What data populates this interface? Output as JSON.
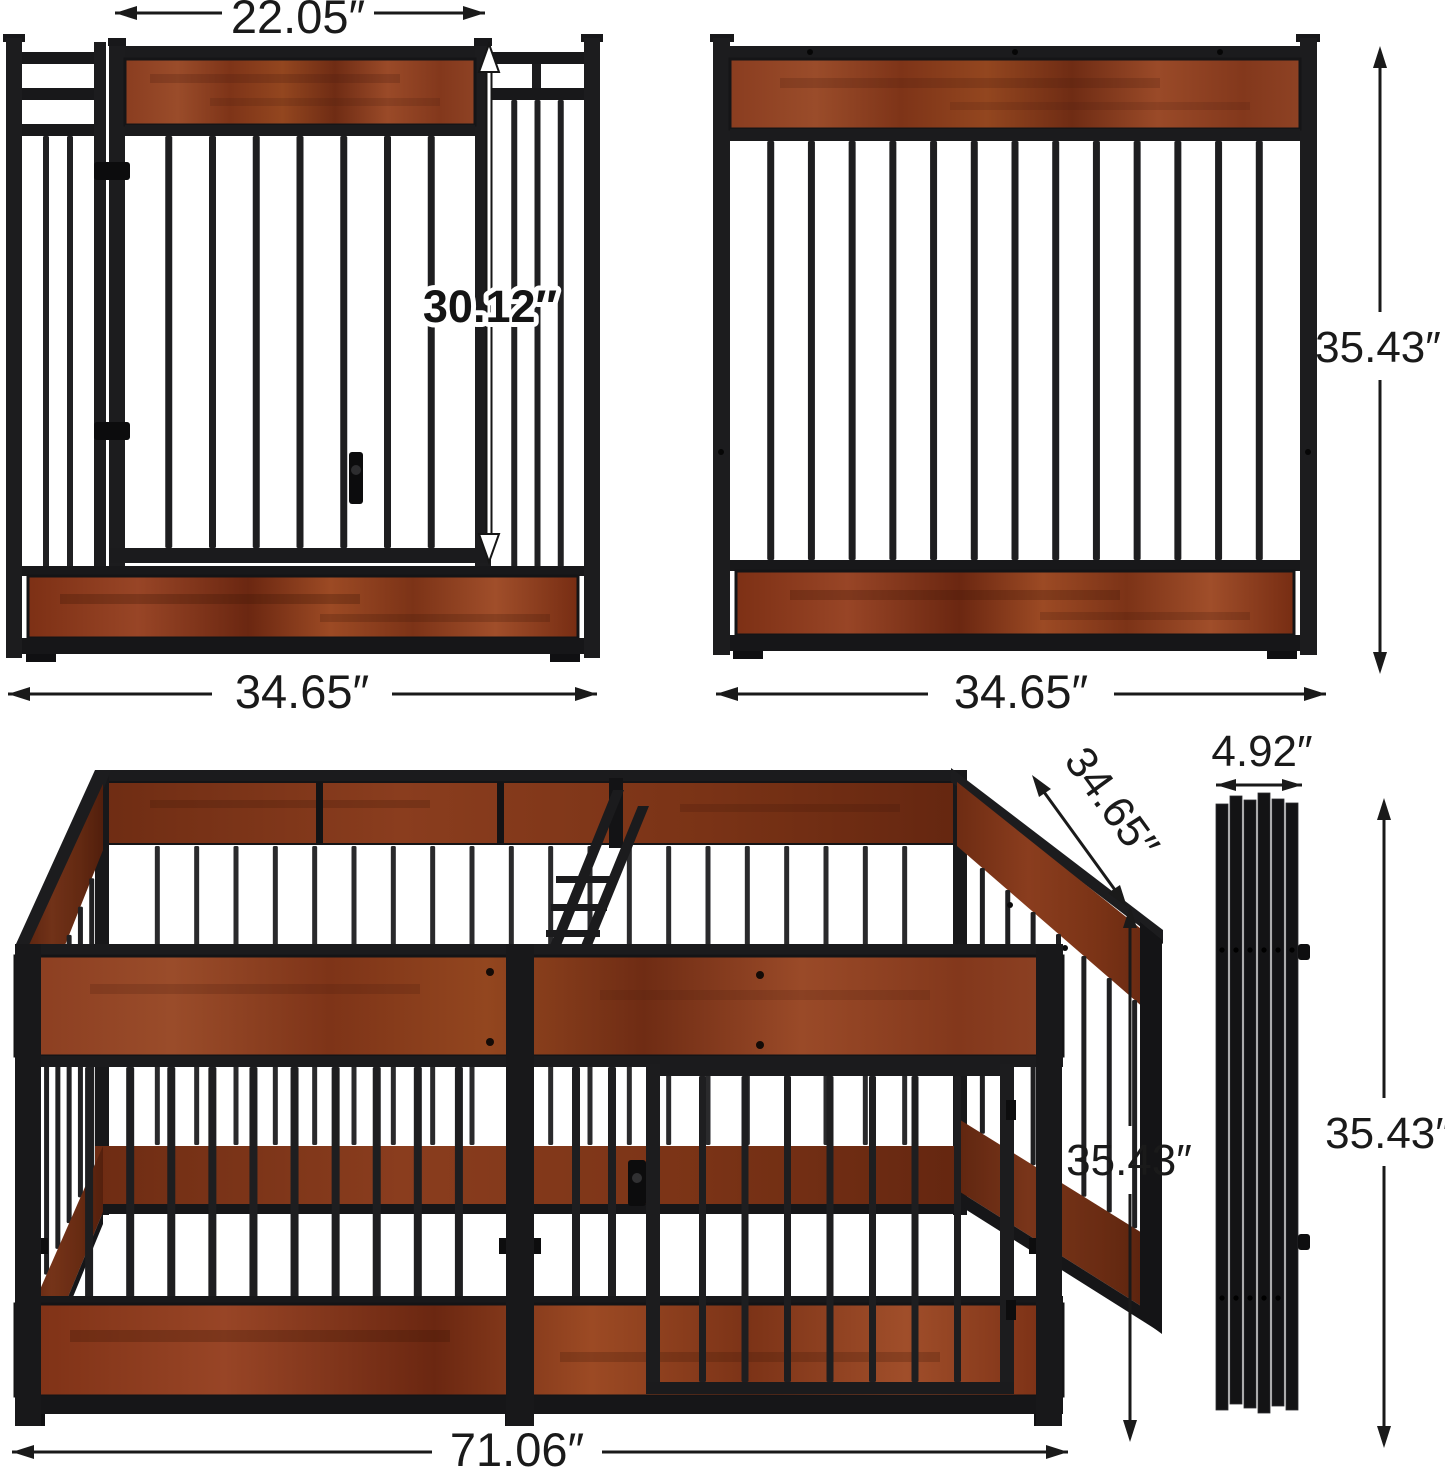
{
  "page": {
    "background": "#ffffff",
    "description": "Dog playpen product dimension diagram with four views"
  },
  "units": "inches",
  "labels": {
    "door_width": "22.05″",
    "door_height": "30.12″",
    "front_panel_width": "34.65″",
    "side_panel_width": "34.65″",
    "panel_height": "35.43″",
    "pen_depth": "34.65″",
    "pen_height": "35.43″",
    "pen_width": "71.06″",
    "folded_width": "4.92″",
    "folded_height": "35.43″"
  },
  "views": {
    "front_panel": {
      "name": "front panel with door"
    },
    "side_panel": {
      "name": "side panel"
    },
    "assembled_pen": {
      "name": "assembled double playpen"
    },
    "folded_panels": {
      "name": "folded flat panels"
    }
  },
  "colors": {
    "metal": "#1c1c1e",
    "metal_dark": "#141416",
    "wood": "#8e4224",
    "wood_dark": "#6b2a13",
    "dimension_text": "#1a1a1a",
    "background": "#ffffff"
  }
}
